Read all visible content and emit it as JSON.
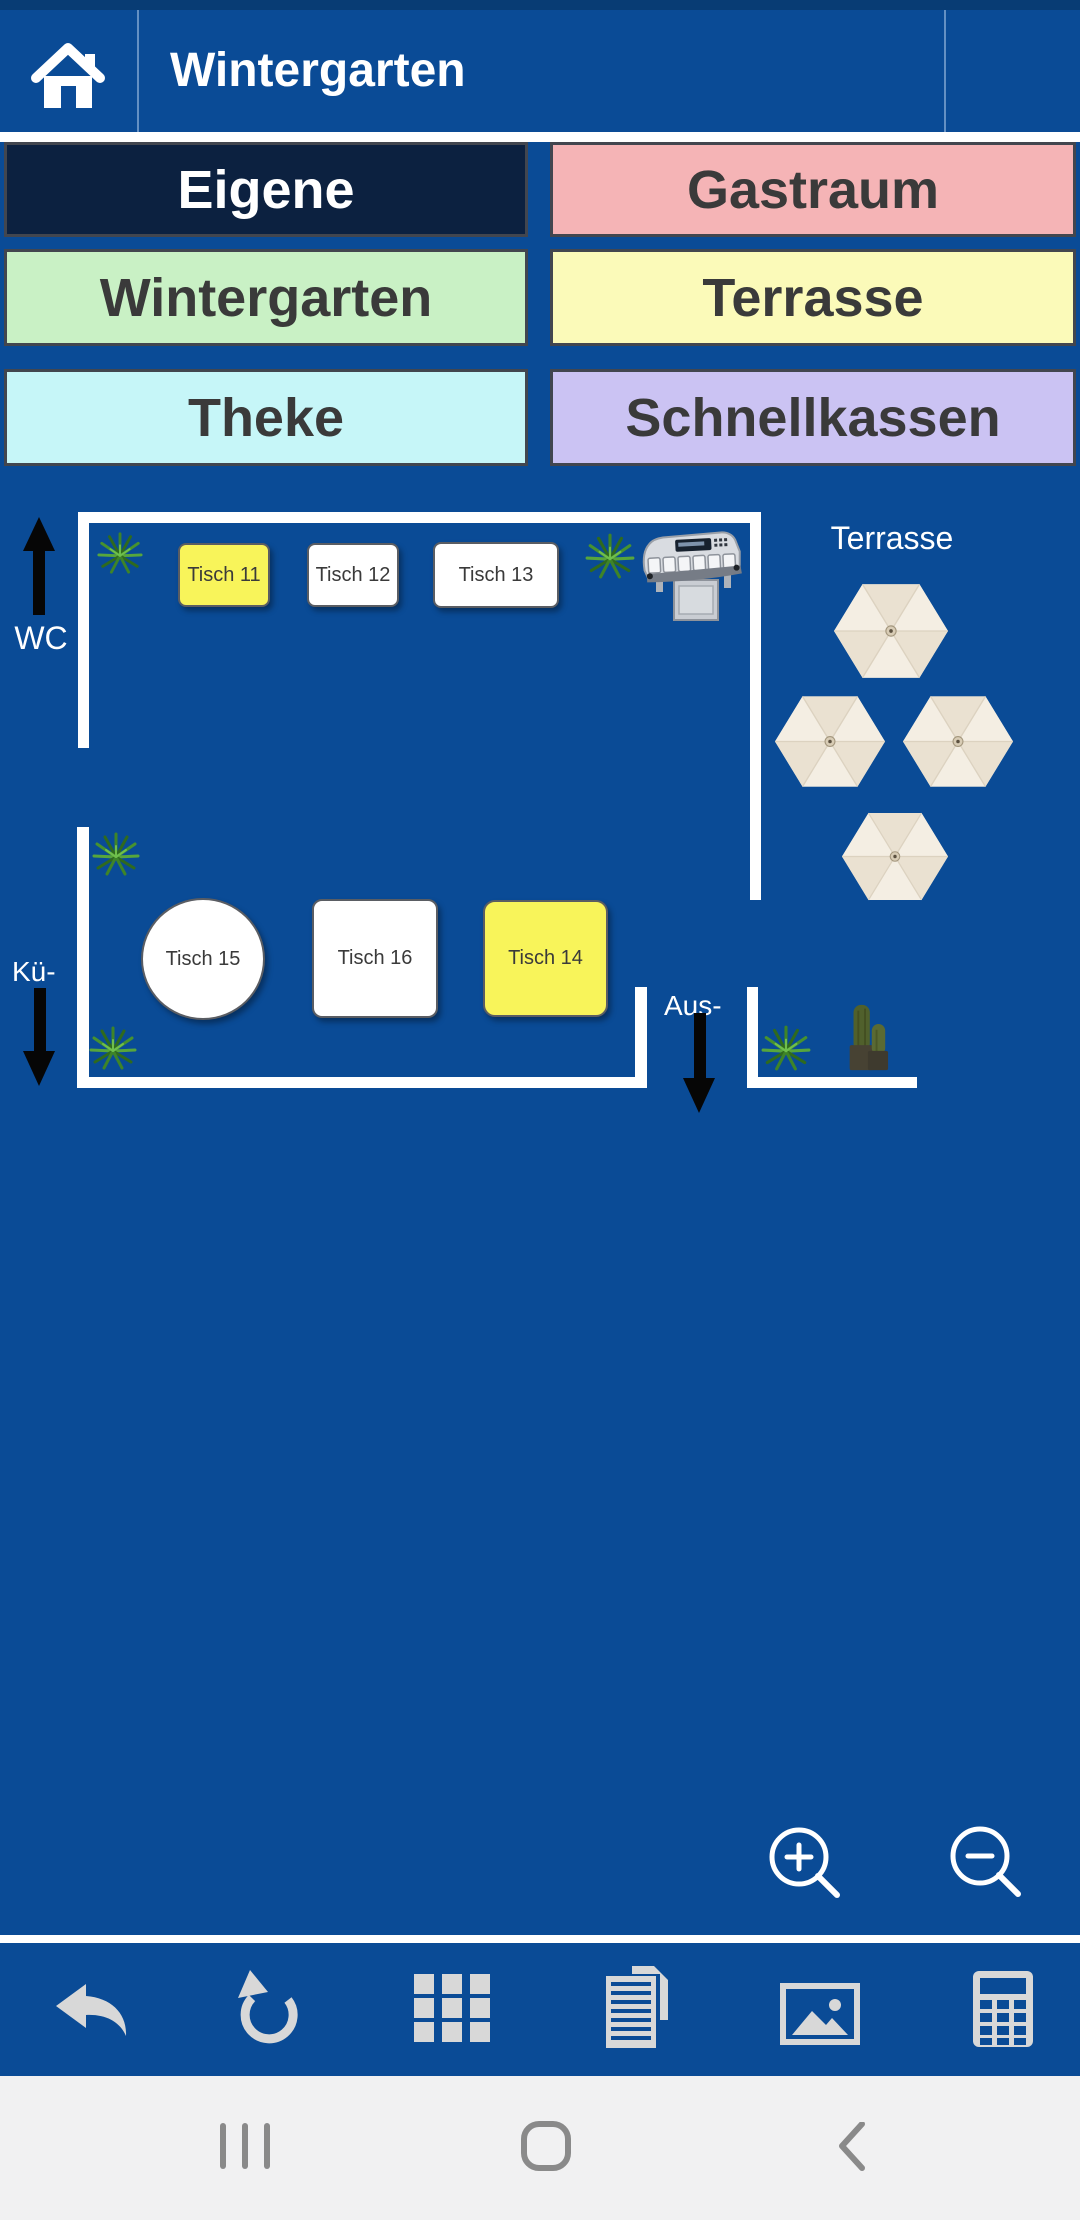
{
  "header": {
    "title": "Wintergarten",
    "home_icon": "home-icon",
    "menu_icon": "hamburger-menu-icon"
  },
  "room_tabs": [
    {
      "label": "Eigene",
      "bg": "#0C2140",
      "text": "#FFFFFF",
      "selected": true
    },
    {
      "label": "Gastraum",
      "bg": "#F5B4B6",
      "text": "#3A3A3A",
      "selected": false
    },
    {
      "label": "Wintergarten",
      "bg": "#C9F1C5",
      "text": "#3A3A3A",
      "selected": false
    },
    {
      "label": "Terrasse",
      "bg": "#FBFAB9",
      "text": "#3A3A3A",
      "selected": false
    },
    {
      "label": "Theke",
      "bg": "#C6F6F8",
      "text": "#3A3A3A",
      "selected": false
    },
    {
      "label": "Schnellkassen",
      "bg": "#CBC3F3",
      "text": "#3A3A3A",
      "selected": false
    }
  ],
  "floor_plan": {
    "region_label": "Terrasse",
    "direction_labels": {
      "wc": "WC",
      "kitchen": "Kü-",
      "exit": "Aus-"
    },
    "tables": [
      {
        "label": "Tisch 11",
        "shape": "rounded-rect",
        "fill": "#F8F45A"
      },
      {
        "label": "Tisch 12",
        "shape": "rounded-rect",
        "fill": "#FFFFFF"
      },
      {
        "label": "Tisch 13",
        "shape": "rounded-rect",
        "fill": "#FFFFFF"
      },
      {
        "label": "Tisch 14",
        "shape": "rounded-rect",
        "fill": "#F8F45A"
      },
      {
        "label": "Tisch 15",
        "shape": "circle",
        "fill": "#FFFFFF"
      },
      {
        "label": "Tisch 16",
        "shape": "rounded-rect",
        "fill": "#FFFFFF"
      }
    ],
    "decor": {
      "plants": 5,
      "parasols": 4,
      "cacti": 2,
      "coin_machine": 1
    }
  },
  "zoom_controls": {
    "zoom_in": "zoom-in-magnifier",
    "zoom_out": "zoom-out-magnifier"
  },
  "toolbar": {
    "icons": [
      "undo-arrow",
      "rotate-ccw",
      "grid",
      "document",
      "image",
      "calculator"
    ]
  },
  "android_nav": {
    "icons": [
      "recents",
      "home",
      "back"
    ]
  },
  "colors": {
    "app_blue": "#0A4B96",
    "status_strip": "#083C74",
    "wall_white": "#FFFFFF",
    "table_yellow": "#F8F45A",
    "selected_tab_navy": "#0C2140",
    "toolbar_icon_gray": "#D8D8D8",
    "nav_bar_bg": "#F1F1F2",
    "nav_icon_gray": "#8A8A8A",
    "parasol_cream": "#EFE7D9"
  }
}
